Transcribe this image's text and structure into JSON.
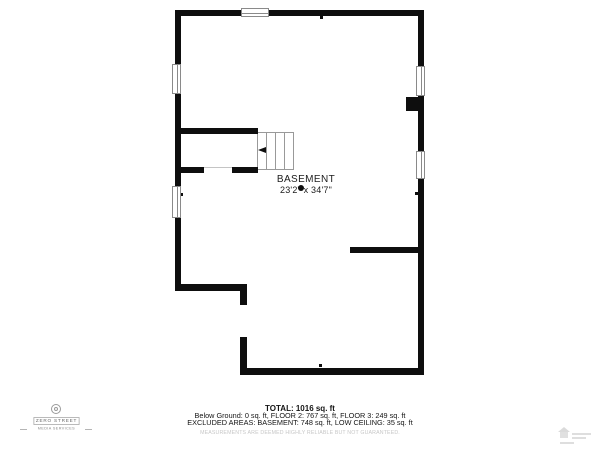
{
  "plan": {
    "room_label": "BASEMENT",
    "room_dimensions": "23'2\" x 34'7\""
  },
  "summary": {
    "total": "TOTAL: 1016 sq. ft",
    "below_ground": "Below Ground: 0 sq. ft, FLOOR 2: 767 sq. ft, FLOOR 3: 249 sq. ft",
    "excluded": "EXCLUDED AREAS: BASEMENT: 748 sq. ft, LOW CEILING: 35 sq. ft",
    "disclaimer": "MEASUREMENTS ARE DEEMED HIGHLY RELIABLE BUT NOT GUARANTEED."
  },
  "logo": {
    "name": "ZERO STREET",
    "tagline": "MEDIA SERVICES"
  },
  "colors": {
    "wall": "#0e0e0e",
    "stair_outline": "#999999",
    "faint_text": "#c7c7c7"
  }
}
